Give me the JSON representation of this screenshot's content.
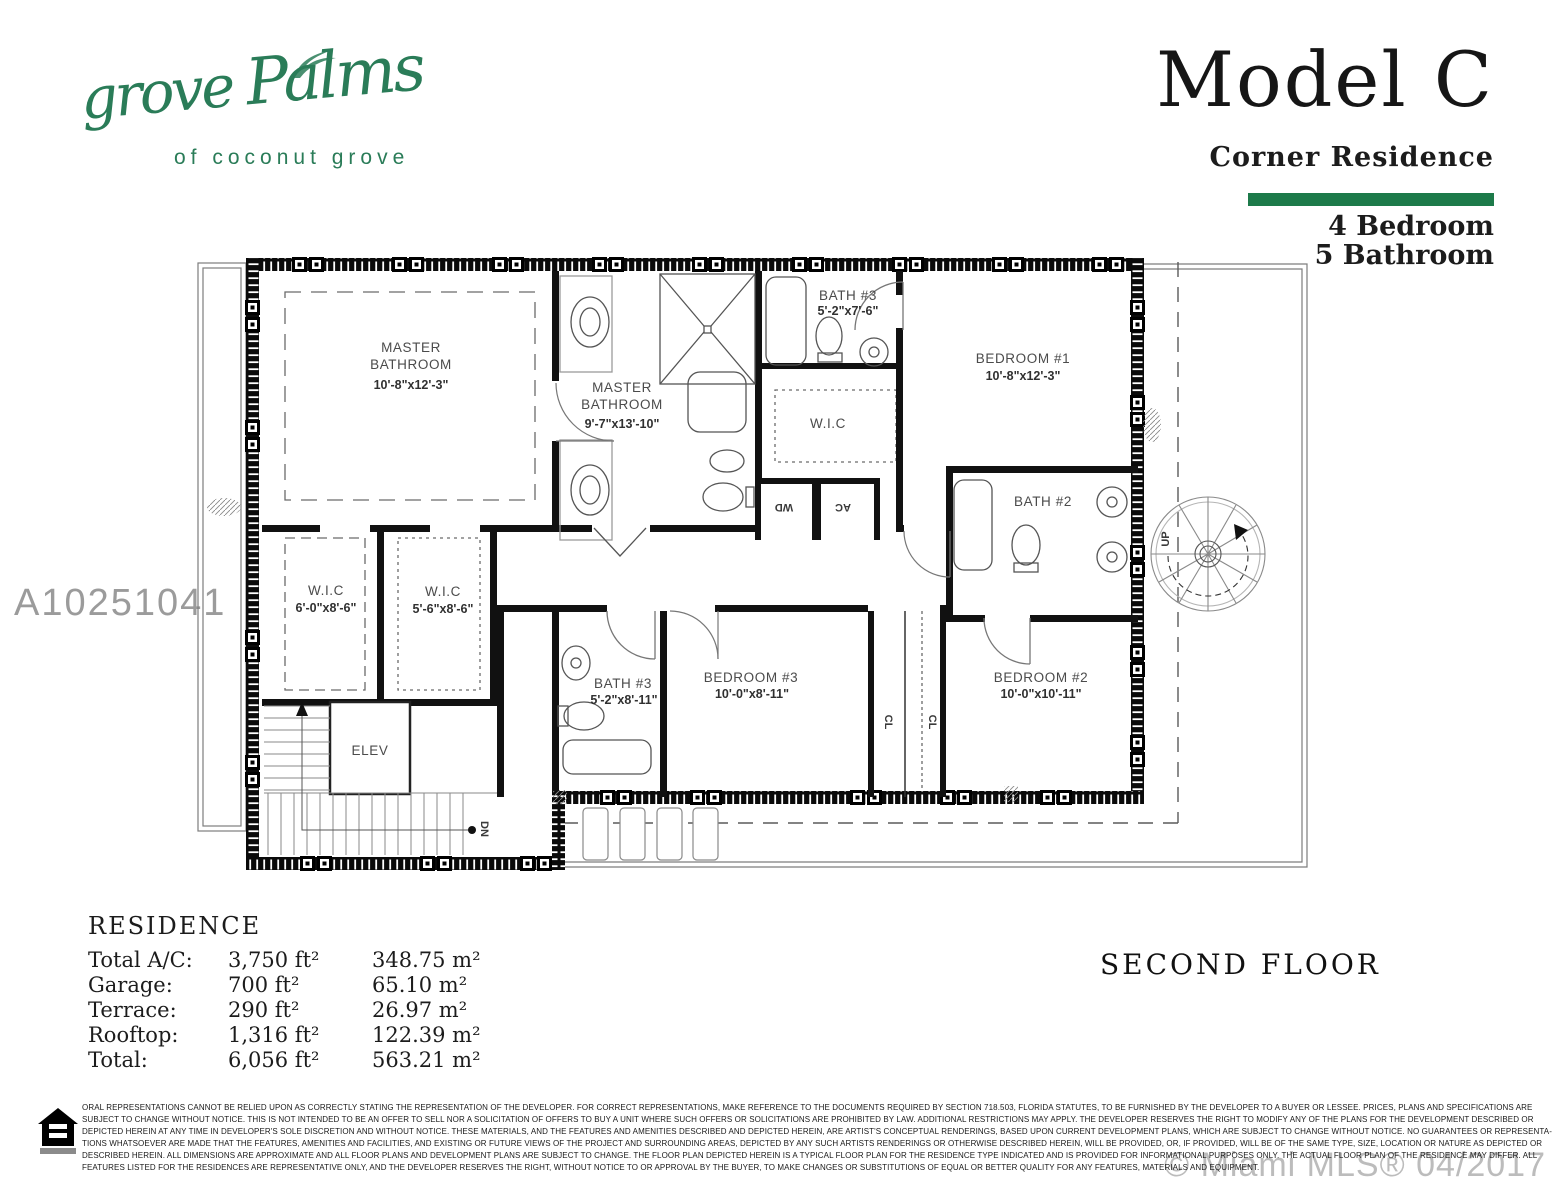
{
  "branding": {
    "script_1": "grove",
    "script_2": "Palms",
    "subtitle": "of coconut grove"
  },
  "header": {
    "model_title": "Model C",
    "residence_type": "Corner Residence",
    "bedrooms": "4 Bedroom",
    "bathrooms": "5 Bathroom"
  },
  "watermarks": {
    "mls_id": "A10251041",
    "copyright": "© Miami MLS® 04/2017"
  },
  "floor_label": "SECOND FLOOR",
  "residence_table": {
    "title": "RESIDENCE",
    "rows": [
      {
        "label": "Total A/C:",
        "ft": "3,750 ft²",
        "m": "348.75 m²"
      },
      {
        "label": "Garage:",
        "ft": "700 ft²",
        "m": "65.10 m²"
      },
      {
        "label": "Terrace:",
        "ft": "290 ft²",
        "m": "26.97 m²"
      },
      {
        "label": "Rooftop:",
        "ft": "1,316 ft²",
        "m": "122.39 m²"
      },
      {
        "label": "Total:",
        "ft": "6,056 ft²",
        "m": "563.21 m²"
      }
    ]
  },
  "floor_plan": {
    "rooms": [
      {
        "id": "master-bedroom",
        "lines": [
          "MASTER",
          "BATHROOM",
          "10'-8\"x12'-3\""
        ]
      },
      {
        "id": "master-bathroom",
        "lines": [
          "MASTER",
          "BATHROOM",
          "9'-7\"x13'-10\""
        ]
      },
      {
        "id": "bath-3-upper",
        "lines": [
          "BATH #3",
          "5'-2\"x7'-6\""
        ]
      },
      {
        "id": "bedroom-1",
        "lines": [
          "BEDROOM #1",
          "10'-8\"x12'-3\""
        ]
      },
      {
        "id": "wic-bedroom-1",
        "lines": [
          "W.I.C"
        ]
      },
      {
        "id": "bath-2",
        "lines": [
          "BATH #2"
        ]
      },
      {
        "id": "wic-master-left",
        "lines": [
          "W.I.C",
          "6'-0\"x8'-6\""
        ]
      },
      {
        "id": "wic-master-right",
        "lines": [
          "W.I.C",
          "5'-6\"x8'-6\""
        ]
      },
      {
        "id": "elevator",
        "lines": [
          "ELEV"
        ]
      },
      {
        "id": "bath-3-lower",
        "lines": [
          "BATH #3",
          "5'-2\"x8'-11\""
        ]
      },
      {
        "id": "bedroom-3",
        "lines": [
          "BEDROOM #3",
          "10'-0\"x8'-11\""
        ]
      },
      {
        "id": "bedroom-2",
        "lines": [
          "BEDROOM #2",
          "10'-0\"x10'-11\""
        ]
      }
    ],
    "annotations": {
      "wd": "WD",
      "ac": "AC",
      "cl": "CL",
      "up": "UP",
      "dn": "DN"
    }
  },
  "disclaimer": {
    "lines": [
      "ORAL REPRESENTATIONS CANNOT BE RELIED UPON AS CORRECTLY STATING THE REPRESENTATION OF THE DEVELOPER. FOR CORRECT REPRESENTATIONS, MAKE REFERENCE TO THE DOCUMENTS REQUIRED BY SECTION 718.503, FLORIDA STATUTES, TO BE FURNISHED BY THE DEVELOPER TO A BUYER OR LESSEE. PRICES, PLANS AND SPECIFICATIONS ARE",
      "SUBJECT TO CHANGE WITHOUT NOTICE. THIS IS NOT INTENDED TO BE AN OFFER TO SELL NOR A SOLICITATION OF OFFERS TO BUY A UNIT WHERE SUCH OFFERS OR SOLICITATIONS ARE PROHIBITED BY LAW. ADDITIONAL RESTRICTIONS MAY APPLY. THE DEVELOPER RESERVES THE RIGHT TO MODIFY ANY OF THE PLANS FOR THE DEVELOPMENT DESCRIBED OR",
      "DEPICTED HEREIN AT ANY TIME IN DEVELOPER'S SOLE DISCRETION AND WITHOUT NOTICE. THESE MATERIALS, AND THE FEATURES AND AMENITIES DESCRIBED AND DEPICTED HEREIN, ARE ARTIST'S CONCEPTUAL RENDERINGS, BASED UPON CURRENT DEVELOPMENT PLANS, WHICH ARE SUBJECT TO CHANGE WITHOUT NOTICE. NO GUARANTEES OR REPRESENTA-",
      "TIONS WHATSOEVER ARE MADE THAT THE FEATURES, AMENITIES AND FACILITIES, AND EXISTING OR FUTURE VIEWS OF THE PROJECT AND SURROUNDING AREAS, DEPICTED BY ANY SUCH ARTISTS RENDERINGS OR OTHERWISE DESCRIBED HEREIN, WILL BE PROVIDED, OR, IF PROVIDED, WILL BE OF THE SAME TYPE, SIZE, LOCATION OR NATURE AS DEPICTED OR",
      "DESCRIBED HEREIN. ALL DIMENSIONS ARE APPROXIMATE AND ALL FLOOR PLANS AND DEVELOPMENT PLANS ARE SUBJECT TO CHANGE. THE FLOOR PLAN DEPICTED HEREIN IS A TYPICAL FLOOR PLAN FOR THE RESIDENCE TYPE INDICATED AND IS PROVIDED FOR INFORMATIONAL PURPOSES ONLY. THE ACTUAL FLOOR PLAN OF THE RESIDENCE MAY DIFFER. ALL",
      "FEATURES LISTED FOR THE RESIDENCES ARE REPRESENTATIVE ONLY, AND THE DEVELOPER RESERVES THE RIGHT, WITHOUT NOTICE TO OR APPROVAL BY THE BUYER, TO MAKE CHANGES OR SUBSTITUTIONS OF EQUAL OR BETTER QUALITY FOR ANY FEATURES, MATERIALS AND EQUIPMENT."
    ]
  },
  "colors": {
    "brand_green": "#1d7a4a",
    "logo_green": "#2a7c58",
    "watermark_gray": "#9b9b9b",
    "copyright_gray": "#bcbcbc"
  }
}
